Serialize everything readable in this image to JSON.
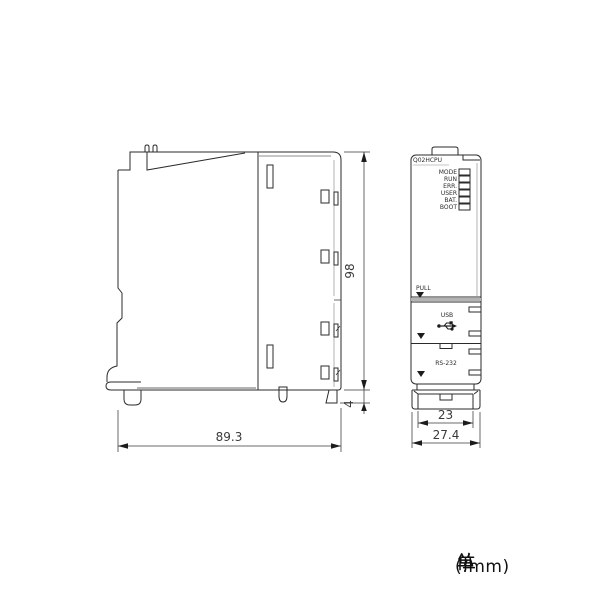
{
  "drawing_title": "CPU module outline dimension drawing",
  "side_view": {
    "dims": {
      "width": "89.3",
      "height": "98",
      "foot": "4"
    }
  },
  "front_view": {
    "model": "Q02HCPU",
    "leds": {
      "labels": [
        "MODE",
        "RUN",
        "ERR.",
        "USER",
        "BAT.",
        "BOOT"
      ]
    },
    "pull": "PULL",
    "usb": "USB",
    "rs232": "RS-232",
    "dims": {
      "inner_width": "23",
      "outer_width": "27.4"
    }
  },
  "unit_note": {
    "text": "(単位：mm)",
    "prefix": "(",
    "kanji": "単位",
    "suffix": ":mm)"
  },
  "colors": {
    "line": "#2b2b2b",
    "shadow": "#b3b3b3",
    "background": "#ffffff"
  }
}
